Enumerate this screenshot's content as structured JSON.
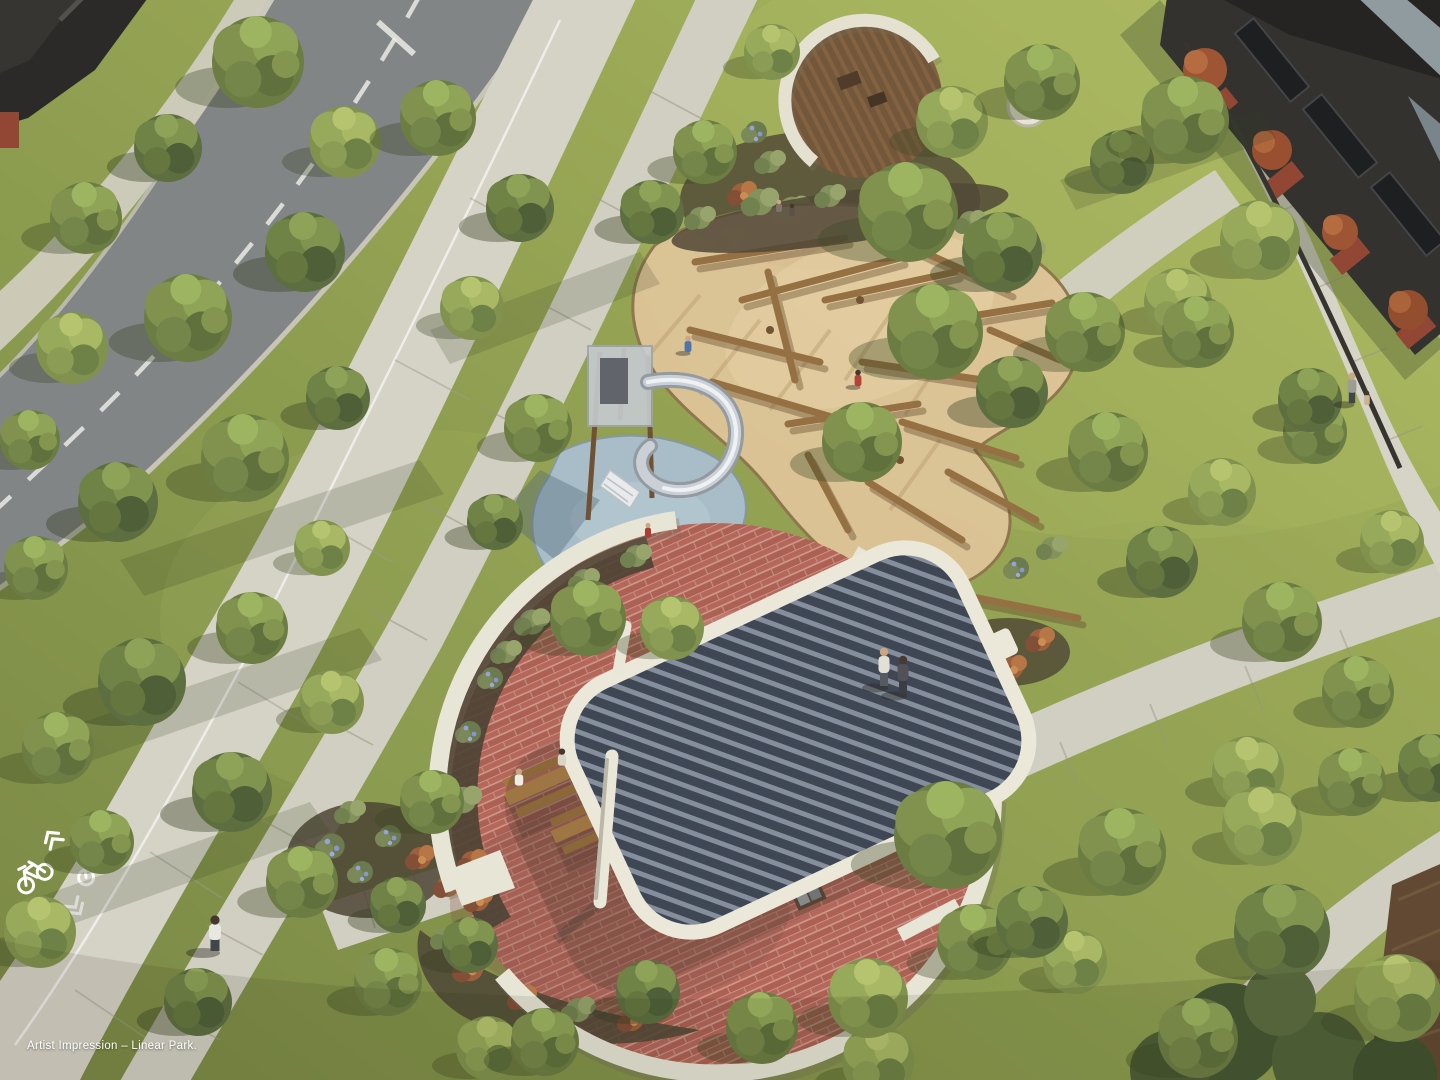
{
  "caption": {
    "text": "Artist Impression – Linear Park."
  },
  "palette": {
    "lawn": "#8a9a4a",
    "lawn_light": "#a7b65f",
    "lawn_shadow": "#5f7038",
    "concrete_path": "#d3d0c4",
    "road_asphalt": "#7d8083",
    "road_marking": "#ffffff",
    "plaza_brick": "#b26156",
    "wall_concrete": "#e7e4d5",
    "pavilion_roof_dark": "#39404f",
    "pavilion_roof_light": "#818a99",
    "pavilion_rim": "#ebe8da",
    "playground_softfall": "#a6bcca",
    "sand": "#dcc294",
    "timber_log": "#916b3d",
    "deck_timber": "#6e5134",
    "building_facade": "#2b2a28",
    "building_brick": "#8e402e",
    "tree_foliage": "#6b7d41"
  },
  "road_markings": {
    "bike_symbols": 2,
    "centerline_style": "dashed"
  }
}
